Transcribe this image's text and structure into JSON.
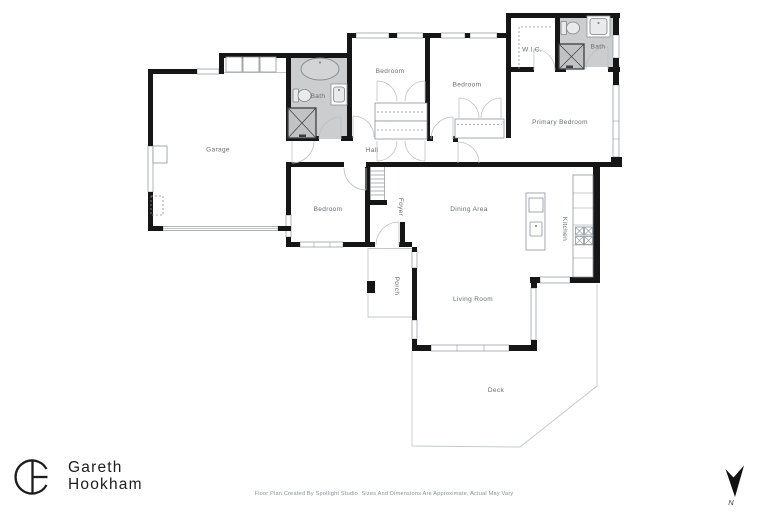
{
  "colors": {
    "wall": "#161616",
    "bath_fill": "#cbcdce",
    "shower_fill": "#c0c2c4",
    "label": "#666d73",
    "door_line": "#bcc0c4",
    "fixture_line": "#8d949b",
    "outline": "#c3c7cb",
    "brand_ink": "#1d1d1f",
    "footer_text": "#8b9096"
  },
  "rooms": {
    "garage": "Garage",
    "bath_upper": "Bath",
    "bedroom_top_left": "Bedroom",
    "bedroom_top_right": "Bedroom",
    "wic": "W.I.C.",
    "bath_primary": "Bath",
    "primary_bedroom": "Primary Bedroom",
    "hall": "Hall",
    "bedroom_middle": "Bedroom",
    "foyer": "Foyer",
    "dining_area": "Dining Area",
    "kitchen": "Kitchen",
    "porch": "Porch",
    "living_room": "Living Room",
    "deck": "Deck"
  },
  "brand": {
    "line1": "Gareth",
    "line2": "Hookham"
  },
  "compass": {
    "north_label": "N"
  },
  "footer": {
    "disclaimer": "Floor Plan Created By Spotlight Studio. Sizes And Dimensions Are Approximate, Actual May Vary"
  }
}
